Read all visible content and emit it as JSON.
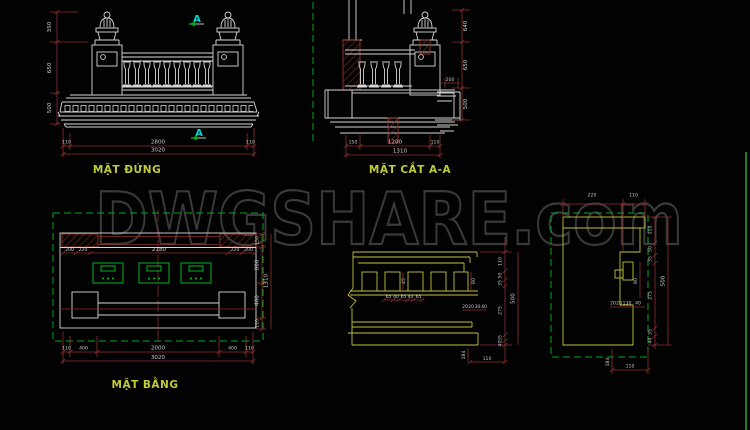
{
  "watermark": {
    "text": "DWGSHARE.com"
  },
  "titles": {
    "elevation": "MẶT ĐỨNG",
    "section": "MẶT CẮT A-A",
    "plan": "MẶT BẰNG"
  },
  "section_marker": "A",
  "colors": {
    "background": "#020202",
    "line_white": "#d6d6d6",
    "line_yellow": "#c3c23a",
    "line_green": "#00a81e",
    "line_cyan": "#00d8d8",
    "dim_red": "#8c2f2f",
    "hatch_red": "#7d2a22",
    "title_yellow": "#c2cc3a",
    "dim_text": "#cfcfcf",
    "watermark_gray": "#3a3a3a"
  },
  "elevation": {
    "dims_left": [
      "350",
      "650",
      "500"
    ],
    "dims_bottom": [
      "110",
      "2800",
      "110"
    ],
    "total": "3020"
  },
  "section": {
    "dims_right": [
      "640",
      "650",
      "500"
    ],
    "dim_inner": "200",
    "dims_bottom": [
      "150",
      "1200",
      "110"
    ],
    "total": "1310"
  },
  "plan": {
    "dims_top": [
      "200",
      "220",
      "2180",
      "220",
      "200"
    ],
    "dims_right": [
      "150",
      "800",
      "400",
      "110"
    ],
    "right_total": "1310",
    "dims_bottom": [
      "110",
      "400",
      "2000",
      "400",
      "110"
    ],
    "total": "3020"
  },
  "cornice": {
    "dim_dentil_h": "45",
    "dim_dentil_w": "80",
    "dims_spacing": [
      "65",
      "40",
      "65",
      "40",
      "65"
    ],
    "dims_small": [
      "20",
      "20",
      "30",
      "40"
    ],
    "dims_right": [
      "110",
      "50",
      "35",
      "275"
    ],
    "overall": "500",
    "dims_lower": [
      "35",
      "40"
    ],
    "dim_foot": "184",
    "dim_bottom": "110"
  },
  "wall": {
    "dims_top": [
      "220",
      "110"
    ],
    "dims_right": [
      "110",
      "50",
      "35",
      "275"
    ],
    "dim_inner": "80",
    "overall": "500",
    "dims_lower": [
      "35",
      "40"
    ],
    "dims_small": [
      "20",
      "20",
      "130",
      "40"
    ],
    "dim_foot": "184",
    "dim_bottom": "110"
  }
}
